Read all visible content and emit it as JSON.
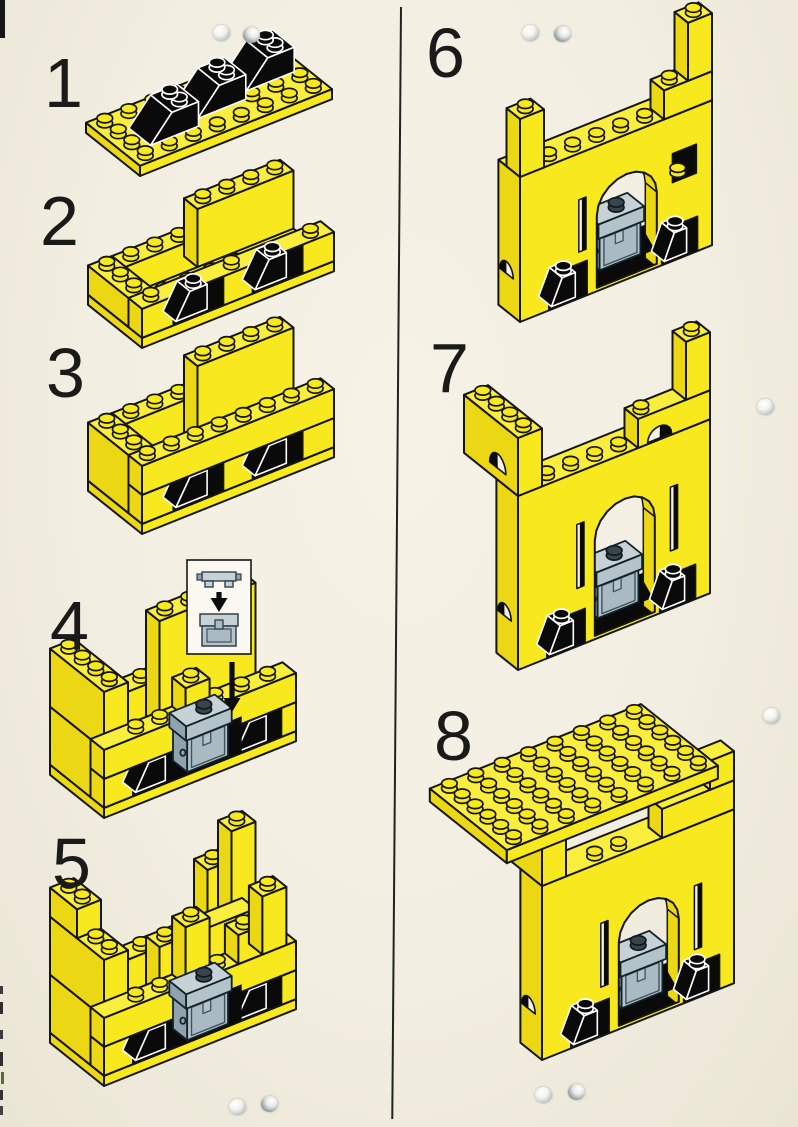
{
  "page": {
    "kind": "LEGO building instructions page",
    "columns": 2,
    "background_color": "#F2EEE1",
    "divider_color": "#222222",
    "punch_holes": 10
  },
  "palette": {
    "brick_yellow": "#F7E91E",
    "brick_yellow_top": "#F9ED3E",
    "brick_yellow_side": "#EBD713",
    "outline": "#161616",
    "black_brick": "#0A0A0A",
    "black_brick_outline": "#FFFFFF",
    "grey_front": "#B4C2CA",
    "grey_top": "#C7D1D6",
    "grey_side": "#8FA2AD",
    "grey_panel": "#A9BAC3",
    "paper": "#F4F1E4",
    "number_color": "#1A1A1A"
  },
  "steps": [
    {
      "number": "1",
      "description": "4x8 yellow plate with three black 2x2 slope bricks"
    },
    {
      "number": "2",
      "description": "first course of yellow bricks built around the slopes"
    },
    {
      "number": "3",
      "description": "second course of yellow wall bricks added"
    },
    {
      "number": "4",
      "description": "corner towers started; grey treasure chest attached at the front",
      "inset": {
        "shows": "grey chest lid placed onto chest base",
        "arrow": "down"
      }
    },
    {
      "number": "5",
      "description": "towers raised higher around the chest"
    },
    {
      "number": "6",
      "description": "archway bridged over the chest; side towers raised"
    },
    {
      "number": "7",
      "description": "wall raised one course; arched windows in the towers"
    },
    {
      "number": "8",
      "description": "6x8 yellow roof plate placed on top"
    }
  ]
}
